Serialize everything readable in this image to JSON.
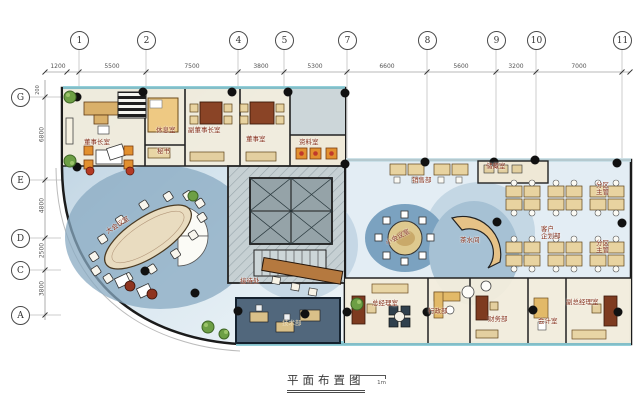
{
  "drawing": {
    "title": "平面布置图",
    "scale_zero": "0",
    "scale_one": "1m"
  },
  "grid": {
    "top_axes": [
      "1",
      "2",
      "4",
      "5",
      "7",
      "8",
      "9",
      "10",
      "11"
    ],
    "top_dims": [
      "1200",
      "5500",
      "7500",
      "3800",
      "5300",
      "6600",
      "5600",
      "3200",
      "7000"
    ],
    "left_axes": [
      "G",
      "E",
      "D",
      "C",
      "A"
    ],
    "left_dims": [
      "6800",
      "4800",
      "2500",
      "3800"
    ],
    "left_top_dim": "200"
  },
  "rooms": {
    "chairman": "董事长室",
    "lounge": "休息室",
    "vice_chairman": "副董事长室",
    "director": "董事室",
    "secretary": "秘书",
    "archive": "资料室",
    "main_meeting": "大会议室",
    "reception": "接待处",
    "tech": "技术部",
    "sales": "销售部",
    "storage": "储藏室",
    "small_meeting": "小会议室",
    "tea": "茶水间",
    "client_planning": "客户\n企划部",
    "zone_manager_1": "分区\n主管",
    "zone_manager_2": "分区\n主管",
    "gm": "总经理室",
    "admin": "行政部",
    "finance": "财务部",
    "accounting": "会计室",
    "deputy_gm": "副总经理室"
  },
  "colors": {
    "floor_blue": "#b9cfdf",
    "furniture_tan": "#e8d3a0",
    "accent_orange": "#e2902f",
    "wall": "#1b1b1b",
    "plant_green": "#6d9f45",
    "glazing_cyan": "#8fd0dc",
    "label_red": "#86311c"
  }
}
